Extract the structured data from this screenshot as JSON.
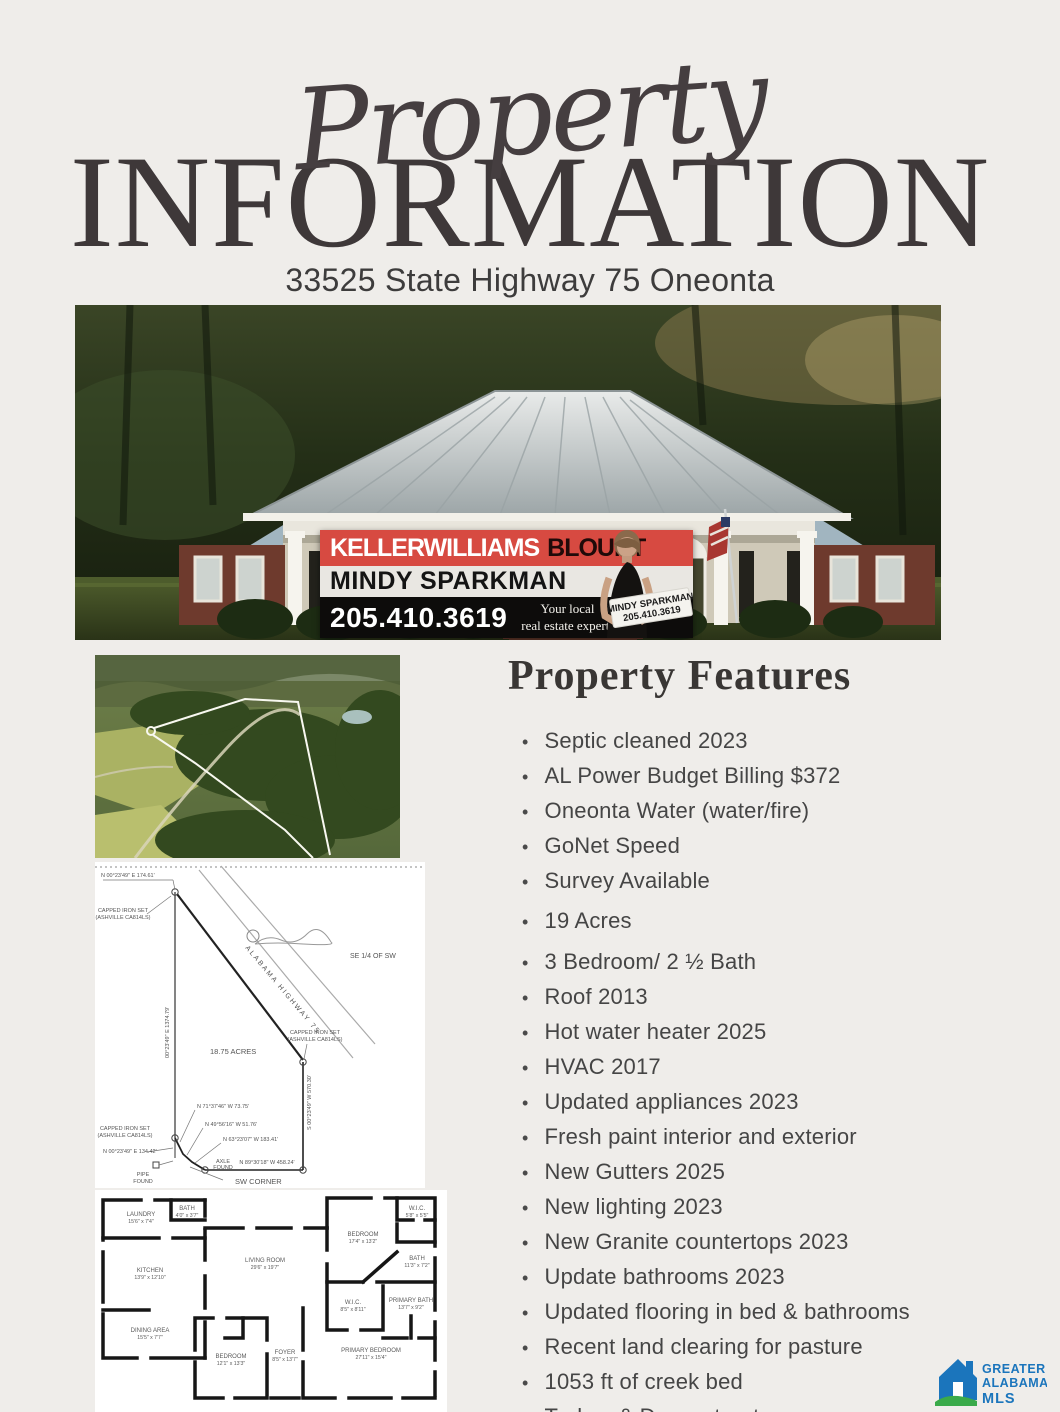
{
  "header": {
    "script_title": "Property",
    "main_title": "INFORMATION",
    "address": "33525 State Highway 75 Oneonta"
  },
  "banner": {
    "brand": "KELLERWILLIAMS",
    "brand_bold": "BLOUNT",
    "agent_name": "MINDY SPARKMAN",
    "phone": "205.410.3619",
    "tagline_line1": "Your local",
    "tagline_line2": "real estate expert!",
    "sign_line1": "MINDY SPARKMAN",
    "sign_line2": "205.410.3619",
    "red": "#d74a41"
  },
  "features": {
    "title": "Property Features",
    "items": [
      "Septic cleaned 2023",
      "AL Power Budget Billing $372",
      "Oneonta Water (water/fire)",
      "GoNet Speed",
      "Survey Available",
      "19 Acres",
      "3 Bedroom/ 2 ½ Bath",
      "Roof 2013",
      "Hot water heater 2025",
      "HVAC 2017",
      "Updated appliances 2023",
      "Fresh paint interior and exterior",
      "New Gutters 2025",
      "New lighting 2023",
      "New Granite countertops 2023",
      "Update bathrooms 2023",
      "Updated flooring in bed & bathrooms",
      "Recent land clearing for pasture",
      "1053 ft of creek bed",
      "Turkey & Deer retreat"
    ]
  },
  "survey": {
    "quarter": "SE 1/4 OF SW",
    "highway": "ALABAMA HIGHWAY 75",
    "acreage": "18.75 ACRES",
    "capped_line1": "CAPPED IRON SET",
    "capped_line2": "(ASHVILLE CA814LS)",
    "bearing_nw": "N 00°23'49\" E  174.61'",
    "west_line": "00°23'49\" E  1374.79'",
    "bearing_1": "N 71°37'46\" W  73.75'",
    "bearing_2": "N 49°56'16\" W  51.76'",
    "bearing_3": "N 63°23'07\" W  183.41'",
    "axle_line1": "AXLE",
    "axle_line2": "FOUND",
    "bearing_south": "N 89°30'18\" W  458.24'",
    "bearing_sw": "N 00°23'49\" E  134.42'",
    "pipe_line1": "PIPE",
    "pipe_line2": "FOUND",
    "sw_corner": "SW CORNER",
    "east_line": "S 00°23'49\" W  570.30'"
  },
  "floorplan": {
    "rooms": [
      {
        "name": "BATH",
        "dims": "4'0\" x 3'7\""
      },
      {
        "name": "LAUNDRY",
        "dims": "15'6\" x 7'4\""
      },
      {
        "name": "KITCHEN",
        "dims": "13'9\" x 12'10\""
      },
      {
        "name": "DINING AREA",
        "dims": "15'5\" x 7'7\""
      },
      {
        "name": "LIVING ROOM",
        "dims": "29'6\" x 19'7\""
      },
      {
        "name": "BEDROOM",
        "dims": "12'1\" x 13'3\""
      },
      {
        "name": "FOYER",
        "dims": "8'5\" x 13'7\""
      },
      {
        "name": "BEDROOM",
        "dims": "17'4\" x 13'2\""
      },
      {
        "name": "W.I.C.",
        "dims": "5'8\" x 5'5\""
      },
      {
        "name": "BATH",
        "dims": "11'3\" x 7'2\""
      },
      {
        "name": "W.I.C.",
        "dims": "8'5\" x 8'11\""
      },
      {
        "name": "PRIMARY BATH",
        "dims": "13'7\" x 9'2\""
      },
      {
        "name": "PRIMARY BEDROOM",
        "dims": "27'11\" x 15'4\""
      }
    ]
  },
  "mls": {
    "line1": "GREATER",
    "line2": "ALABAMA",
    "line3": "MLS",
    "blue": "#1b75bc",
    "green": "#3aaa4a"
  }
}
